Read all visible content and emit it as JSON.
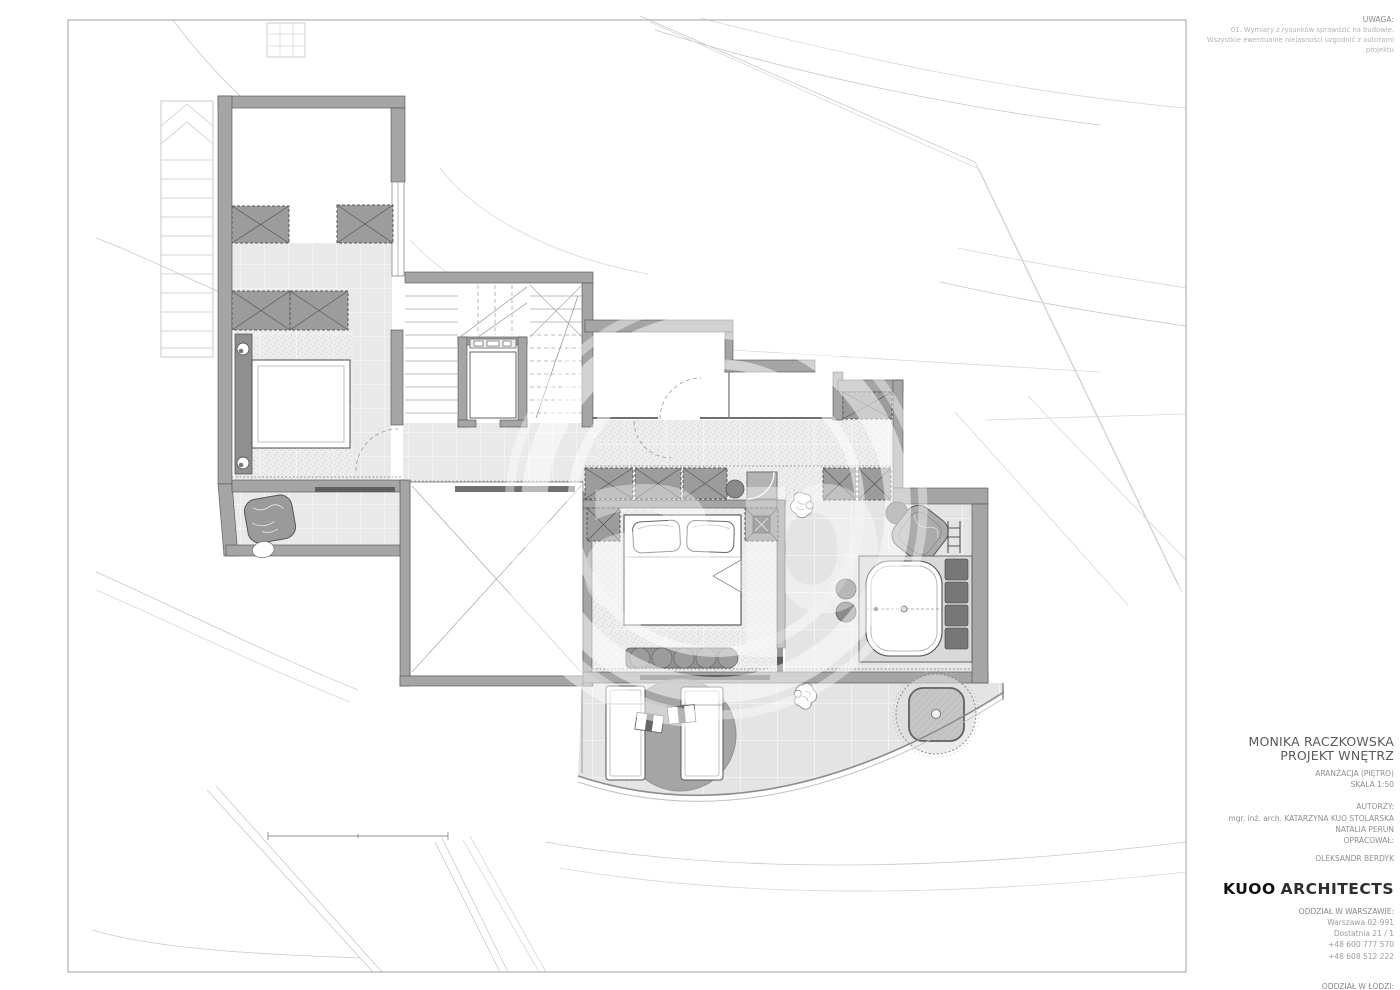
{
  "note": {
    "title": "UWAGA:",
    "lines": [
      "01. Wymiary z rysunków sprawdzić na budowie.",
      "Wszystkie ewentualne niejasności uzgodnić z autorami",
      "projektu"
    ]
  },
  "title_block": {
    "client_line1": "MONIKA RACZKOWSKA",
    "client_line2": "PROJEKT WNĘTRZ",
    "drawing_name": "ARANŻACJA (PIĘTRO)",
    "scale": "SKALA 1:50",
    "authors_label": "AUTORZY:",
    "author1": "mgr. inż. arch. KATARZYNA KUO STOLARSKA",
    "author2": "NATALIA PERUŃ",
    "prepared_label": "OPRACOWAŁ:",
    "prepared_by": "OLEKSANDR BERDYK",
    "studio_name_bold": "KUOO",
    "studio_name_rest": "ARCHITECTS",
    "office1": {
      "label": "ODDZIAŁ W WARSZAWIE:",
      "lines": [
        "Warszawa 02-991",
        "Dostatnia 21 / 1",
        "+48 600 777 570",
        "+48 608 512 222"
      ]
    },
    "office2": {
      "label": "ODDZIAŁ W ŁODZI:",
      "lines": [
        "Łódź 90-056",
        "Off Piotrkowska - Roosevelta 10 C",
        "+48 600 777 570",
        "+48 608 512 222"
      ]
    }
  },
  "watermark": {
    "letters": "ap"
  },
  "palette": {
    "paper": "#ffffff",
    "wall_fill": "#a5a5a5",
    "wall_edge": "#4f4f4f",
    "floor_tile": "#e8e8e8",
    "carpet": "#ededed",
    "furniture_dark": "#8e8e8e",
    "site_line": "#c9c9c9",
    "text_dark": "#101010",
    "text_gray": "#8f8f8f"
  }
}
